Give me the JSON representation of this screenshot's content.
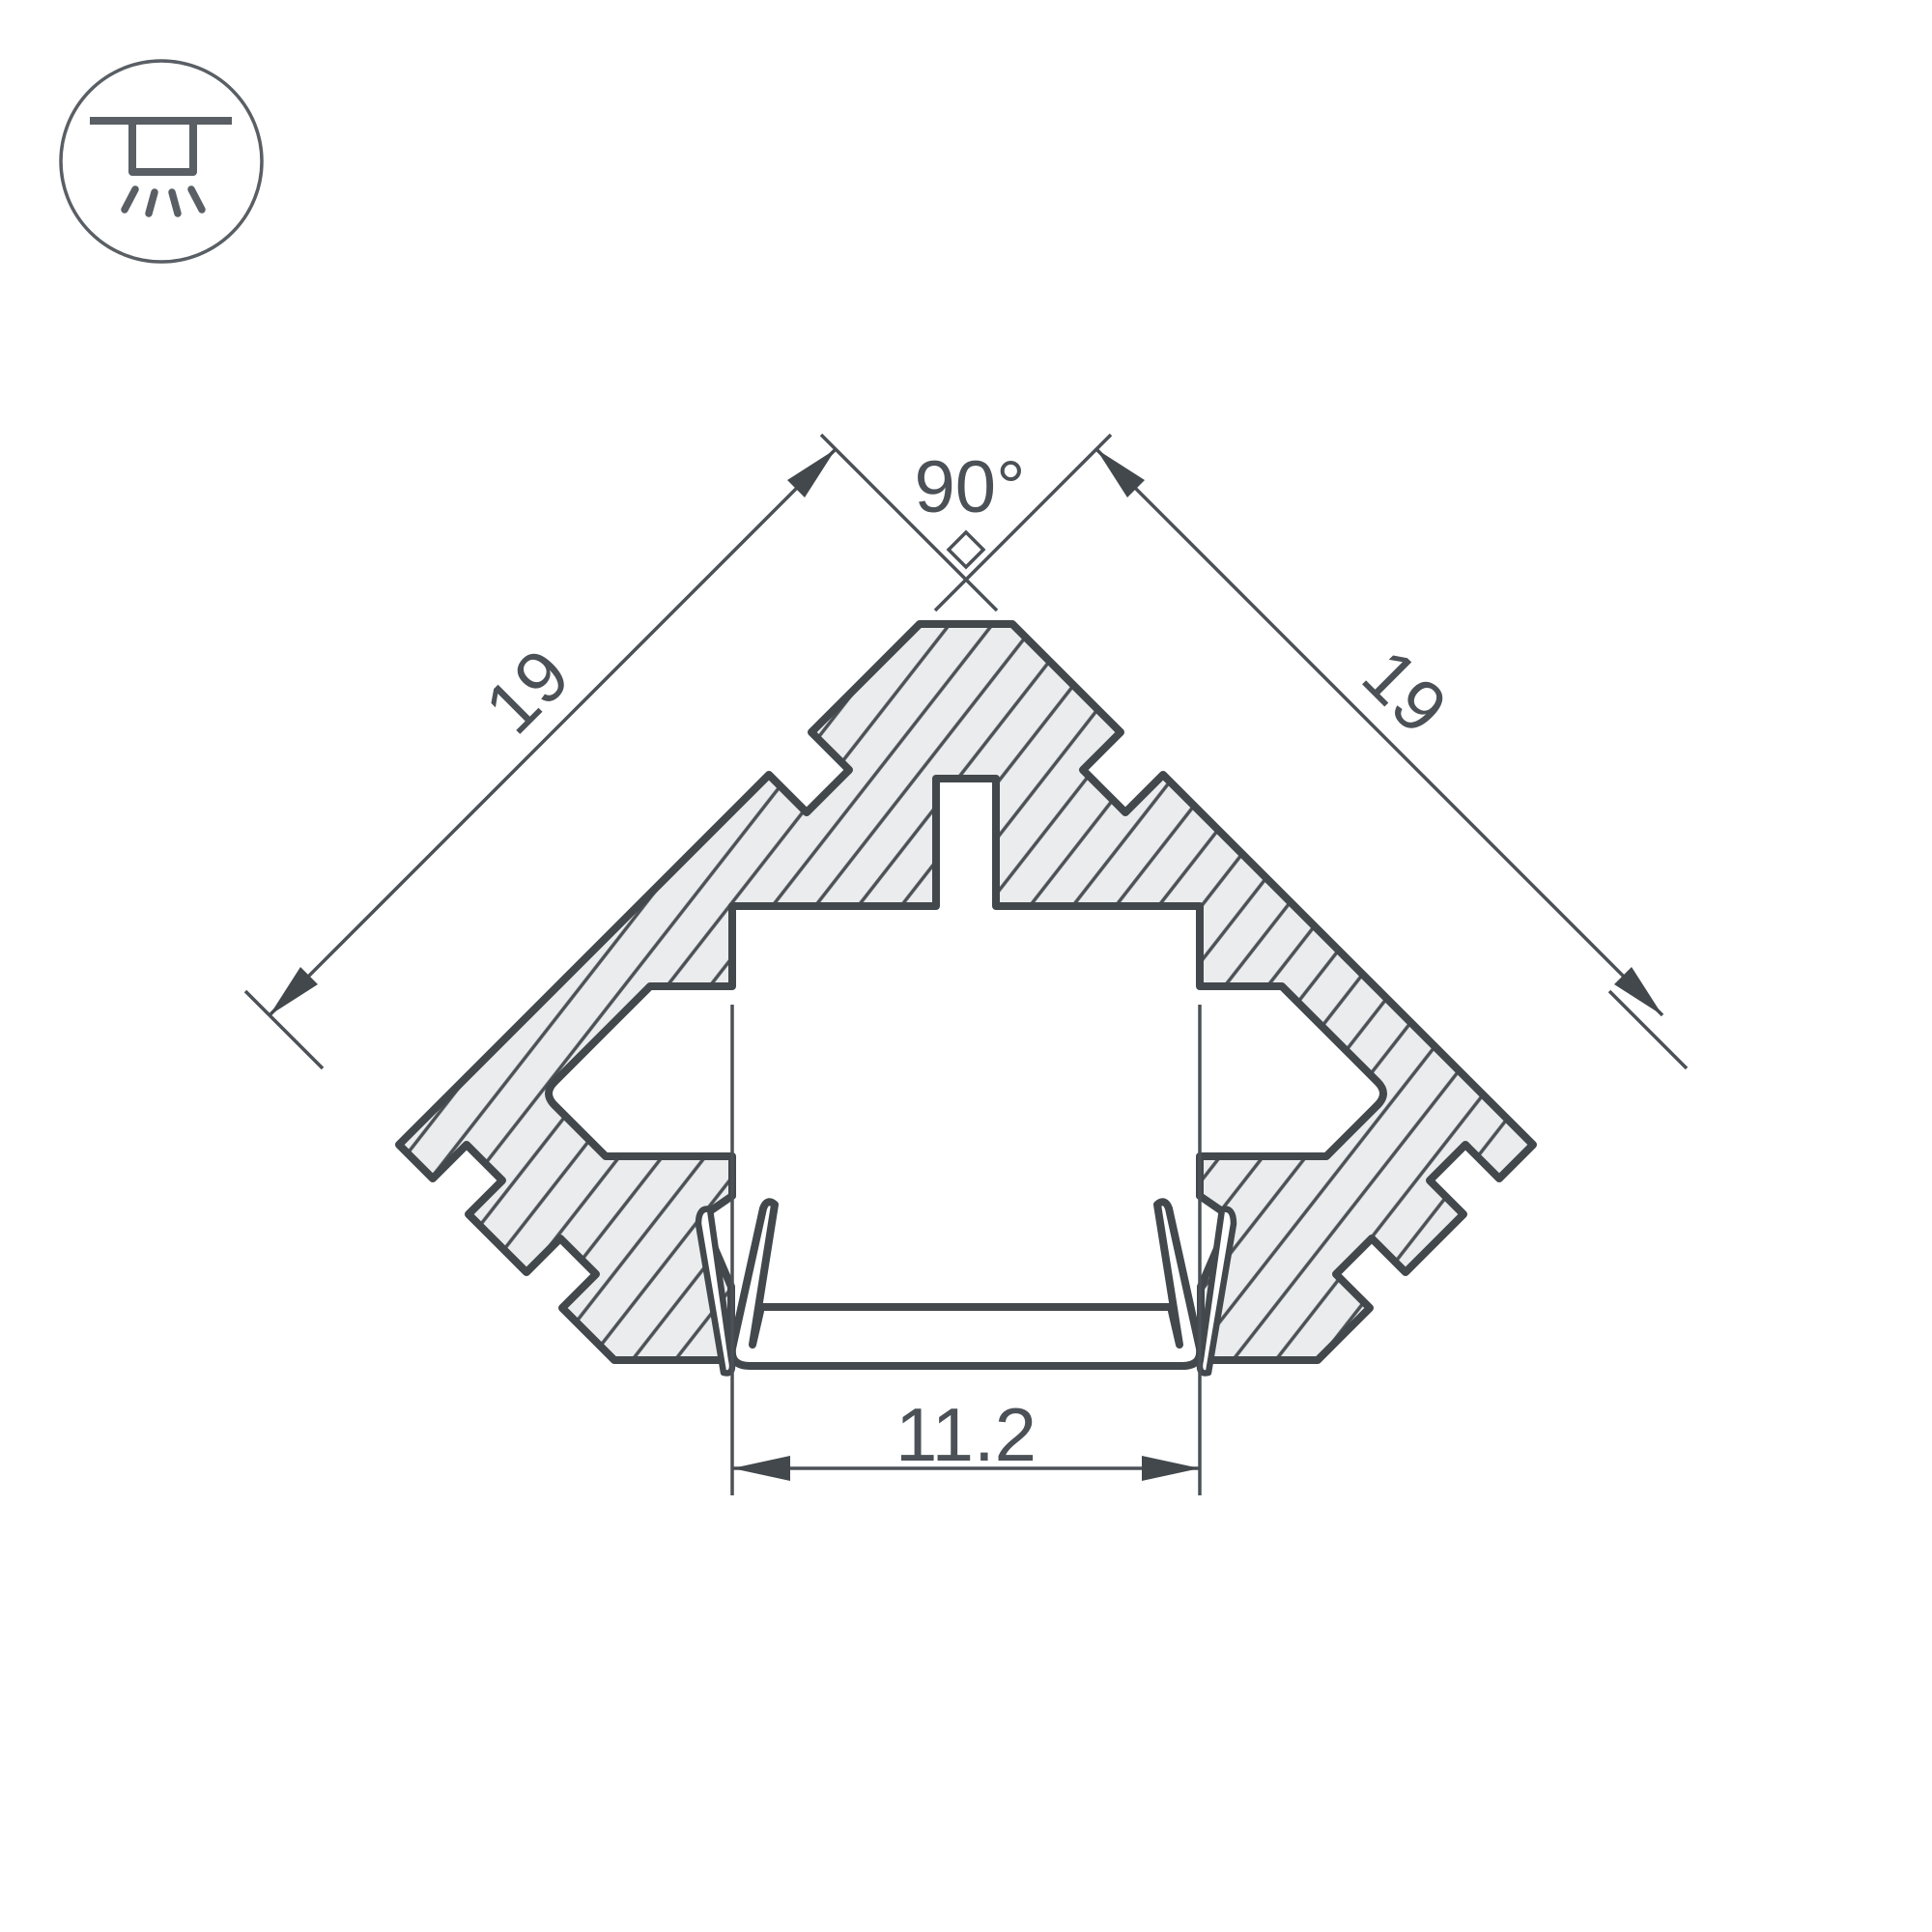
{
  "drawing": {
    "title": "led-corner-profile-cross-section",
    "icon": {
      "name": "recessed-ceiling-light-icon"
    },
    "dimensions": {
      "angle": "90°",
      "left_side": "19",
      "right_side": "19",
      "bottom_width": "11.2"
    }
  },
  "colors": {
    "ink": "#42484c",
    "hatch-ink": "#4b5156",
    "metal-fill": "#ebeced",
    "text-ink": "#4b5156",
    "background": "#ffffff"
  }
}
